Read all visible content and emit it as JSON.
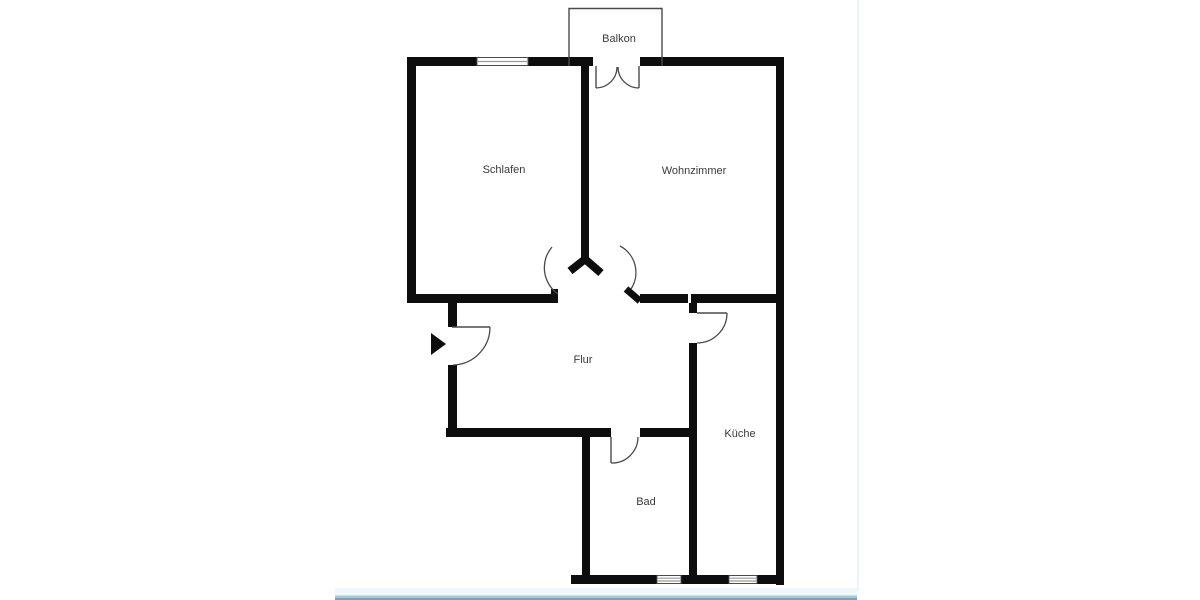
{
  "floor_plan": {
    "rooms": {
      "balkon": {
        "label": "Balkon"
      },
      "schlafen": {
        "label": "Schlafen"
      },
      "wohnzimmer": {
        "label": "Wohnzimmer"
      },
      "flur": {
        "label": "Flur"
      },
      "bad": {
        "label": "Bad"
      },
      "kueche": {
        "label": "Küche"
      }
    },
    "icons": {
      "entrance_arrow": "right-pointing-triangle"
    }
  },
  "colors": {
    "wall": "#0d0d0d",
    "line": "#4a4a4a",
    "window_line": "#9a9a9a",
    "text": "#3a3a3a",
    "strip_light": "#eff7fb",
    "strip_mid": "#a6c8d9",
    "strip_dark": "#7da3b8",
    "edge_faint": "#edf4f8"
  }
}
